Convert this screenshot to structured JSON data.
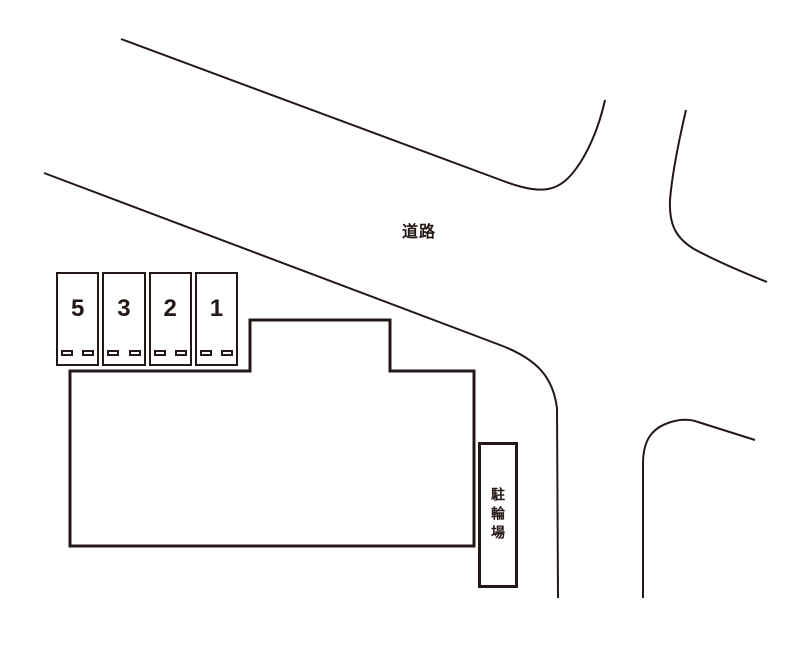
{
  "colors": {
    "line": "#231815",
    "background": "#ffffff"
  },
  "labels": {
    "road": "道路",
    "bicycle_parking": "駐輪場"
  },
  "parking": {
    "stalls": [
      {
        "label": "5"
      },
      {
        "label": "3"
      },
      {
        "label": "2"
      },
      {
        "label": "1"
      }
    ]
  }
}
